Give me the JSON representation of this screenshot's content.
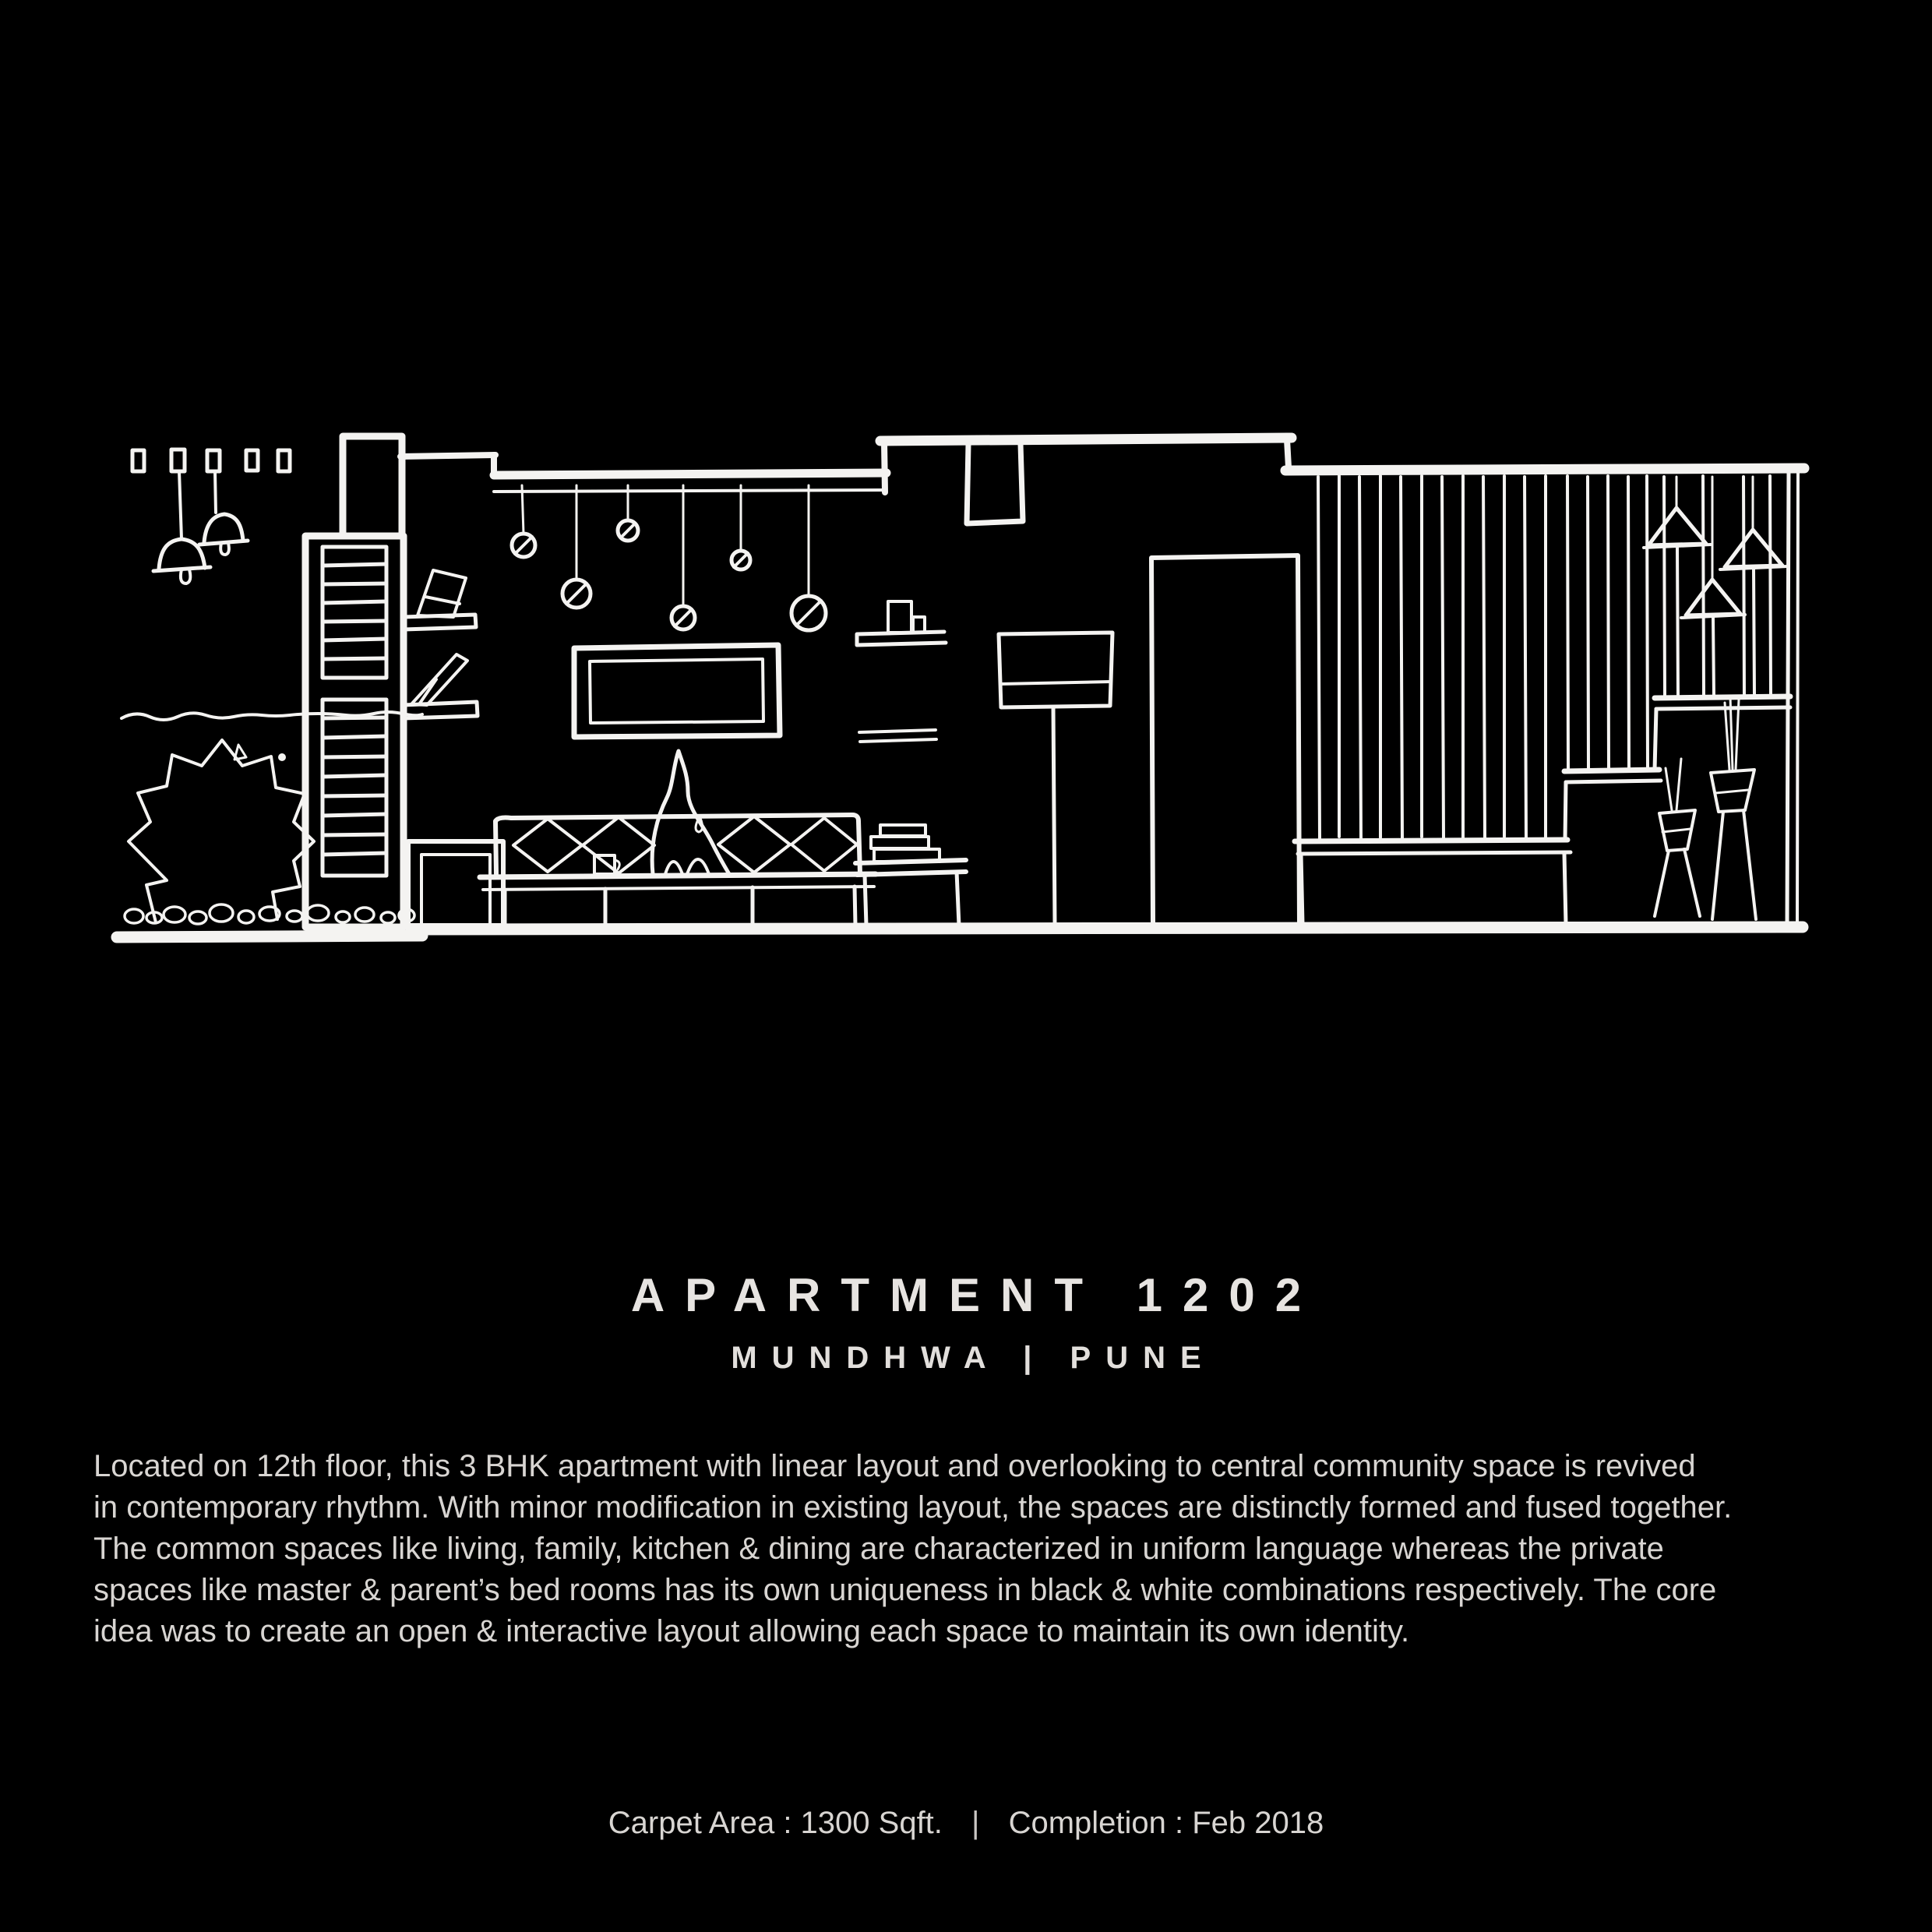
{
  "page": {
    "background_color": "#000000",
    "text_color": "#d8d5d2",
    "sketch_stroke_color": "#f4f3f1"
  },
  "title": {
    "name": "APARTMENT 1202",
    "location": "MUNDHWA | PUNE"
  },
  "description": {
    "lines": [
      "Located on 12th floor, this 3 BHK apartment with linear layout and overlooking to central community space is revived",
      "in contemporary rhythm. With minor modification in existing layout, the spaces are distinctly formed and fused together.",
      "The common spaces like living, family, kitchen & dining are characterized in uniform language whereas the private",
      "spaces like master & parent’s bed rooms has its own uniqueness in black & white combinations respectively. The core",
      "idea was to create an open & interactive layout allowing each space to maintain its own identity."
    ]
  },
  "footer": {
    "carpet_area": "Carpet Area : 1300 Sqft.",
    "separator": "|",
    "completion": "Completion : Feb 2018"
  },
  "sketch": {
    "elements": [
      "track-lights",
      "bell-pendant-lamps",
      "garden-bush",
      "pebbles",
      "ladder-shelf-column",
      "wall-shelves-with-books",
      "dropped-ceiling",
      "bulb-pendant-lamps",
      "wall-frame",
      "sofa-with-cushions",
      "cat-figure",
      "coffee-mug",
      "side-table-with-books",
      "small-wall-shelf",
      "floor-lamp",
      "ceiling-beam",
      "doorway",
      "slatted-partition",
      "steps-platform",
      "cone-pendant-lamps",
      "planter-vases",
      "right-wall",
      "floor-line"
    ]
  }
}
